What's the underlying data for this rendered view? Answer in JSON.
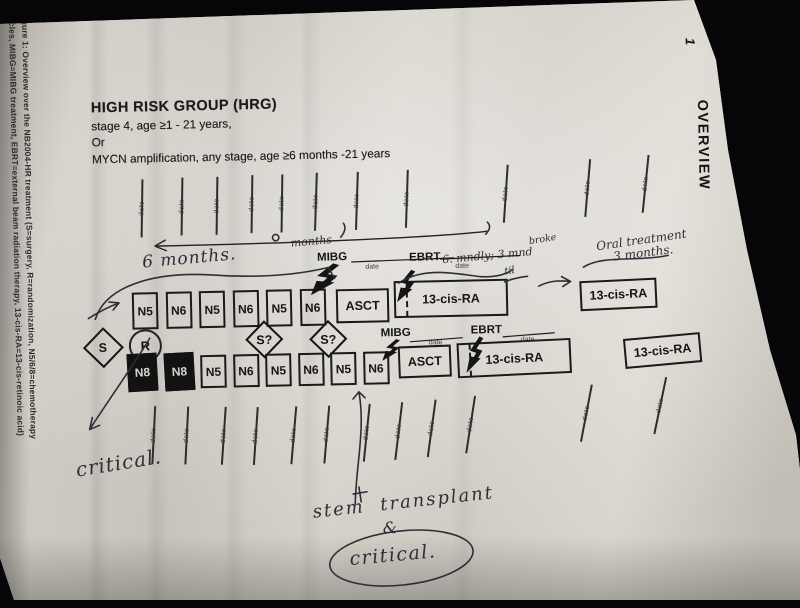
{
  "caption": {
    "line1": "Figure 1: Overview over the NB2004-HR treatment (S=surgery, R=randomization, N5/6/8=chemotherapy",
    "line2": "cycles, MIBG=MIBG treatment, EBRT=external beam radiation therapy, 13-cis-RA=13-cis-retinoic acid)"
  },
  "side_tab": {
    "label": "OVERVIEW",
    "page_number": "1"
  },
  "header": {
    "title": "HIGH RISK GROUP (HRG)",
    "line1": "stage 4, age ≥1 - 21 years,",
    "line2": "Or",
    "line3": "MYCN amplification, any stage, age ≥6 months -21 years"
  },
  "timeline": {
    "tick_label": "date"
  },
  "protocol": {
    "s_node": "S",
    "r_node": "R",
    "surgery_q1": "S?",
    "surgery_q2": "S?",
    "mibg_label": "MIBG",
    "ebrt_label": "EBRT",
    "date_label": "date",
    "arm1": {
      "chemo": [
        "N5",
        "N6",
        "N5",
        "N6",
        "N5",
        "N6"
      ],
      "asct": "ASCT",
      "ra_long": "13-cis-RA",
      "ra_right": "13-cis-RA"
    },
    "arm2": {
      "chemo": [
        {
          "label": "N8",
          "cls": "filled"
        },
        {
          "label": "N8",
          "cls": "filled"
        },
        "N5",
        "N6",
        "N5",
        "N6",
        "N5",
        "N6"
      ],
      "asct": "ASCT",
      "ra_long": "13-cis-RA",
      "ra_right": "13-cis-RA"
    }
  },
  "handwriting": {
    "six_months": "6 months.",
    "months": "months",
    "broke": "broke",
    "interval": "6. mndly; 3 mnd",
    "til": "til",
    "oral_line1": "Oral treatment",
    "oral_line2": "3 months.",
    "critical_left": "critical.",
    "stem_transplant": "stem transplant",
    "ampersand": "&",
    "critical_circled": "critical."
  },
  "colors": {
    "pen_ink": "#2e2e38",
    "print_ink": "#1b1b1b",
    "paper": "#cdc9c1"
  }
}
